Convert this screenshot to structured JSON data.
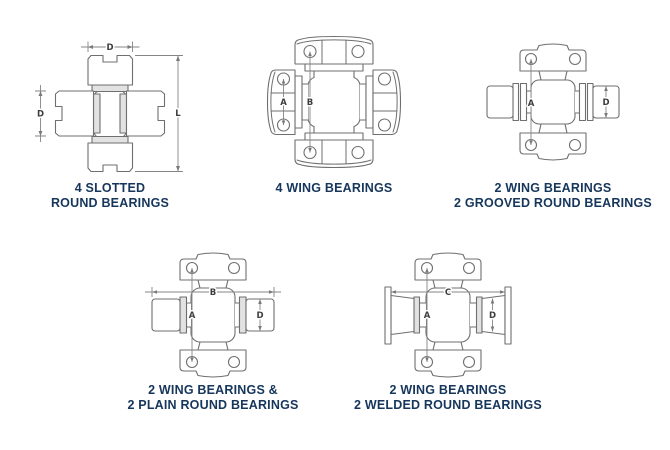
{
  "page": {
    "background": "#ffffff",
    "caption_color": "#16365c",
    "line_color": "#6f6f6f",
    "dimension_label_color": "#3d3d3d"
  },
  "diagrams": [
    {
      "id": "four-slotted-round-bearings",
      "caption": [
        "4 SLOTTED",
        "ROUND BEARINGS"
      ],
      "dims": [
        "D",
        "D",
        "L"
      ]
    },
    {
      "id": "four-wing-bearings",
      "caption": [
        "4 WING BEARINGS"
      ],
      "dims": [
        "A",
        "B"
      ]
    },
    {
      "id": "two-wing-two-grooved-round-bearings",
      "caption": [
        "2 WING BEARINGS",
        "2 GROOVED ROUND BEARINGS"
      ],
      "dims": [
        "A",
        "D"
      ]
    },
    {
      "id": "two-wing-two-plain-round-bearings",
      "caption": [
        "2 WING BEARINGS &",
        "2 PLAIN ROUND BEARINGS"
      ],
      "dims": [
        "A",
        "B",
        "D"
      ]
    },
    {
      "id": "two-wing-two-welded-round-bearings",
      "caption": [
        "2 WING BEARINGS",
        "2 WELDED ROUND BEARINGS"
      ],
      "dims": [
        "A",
        "C",
        "D"
      ]
    }
  ]
}
